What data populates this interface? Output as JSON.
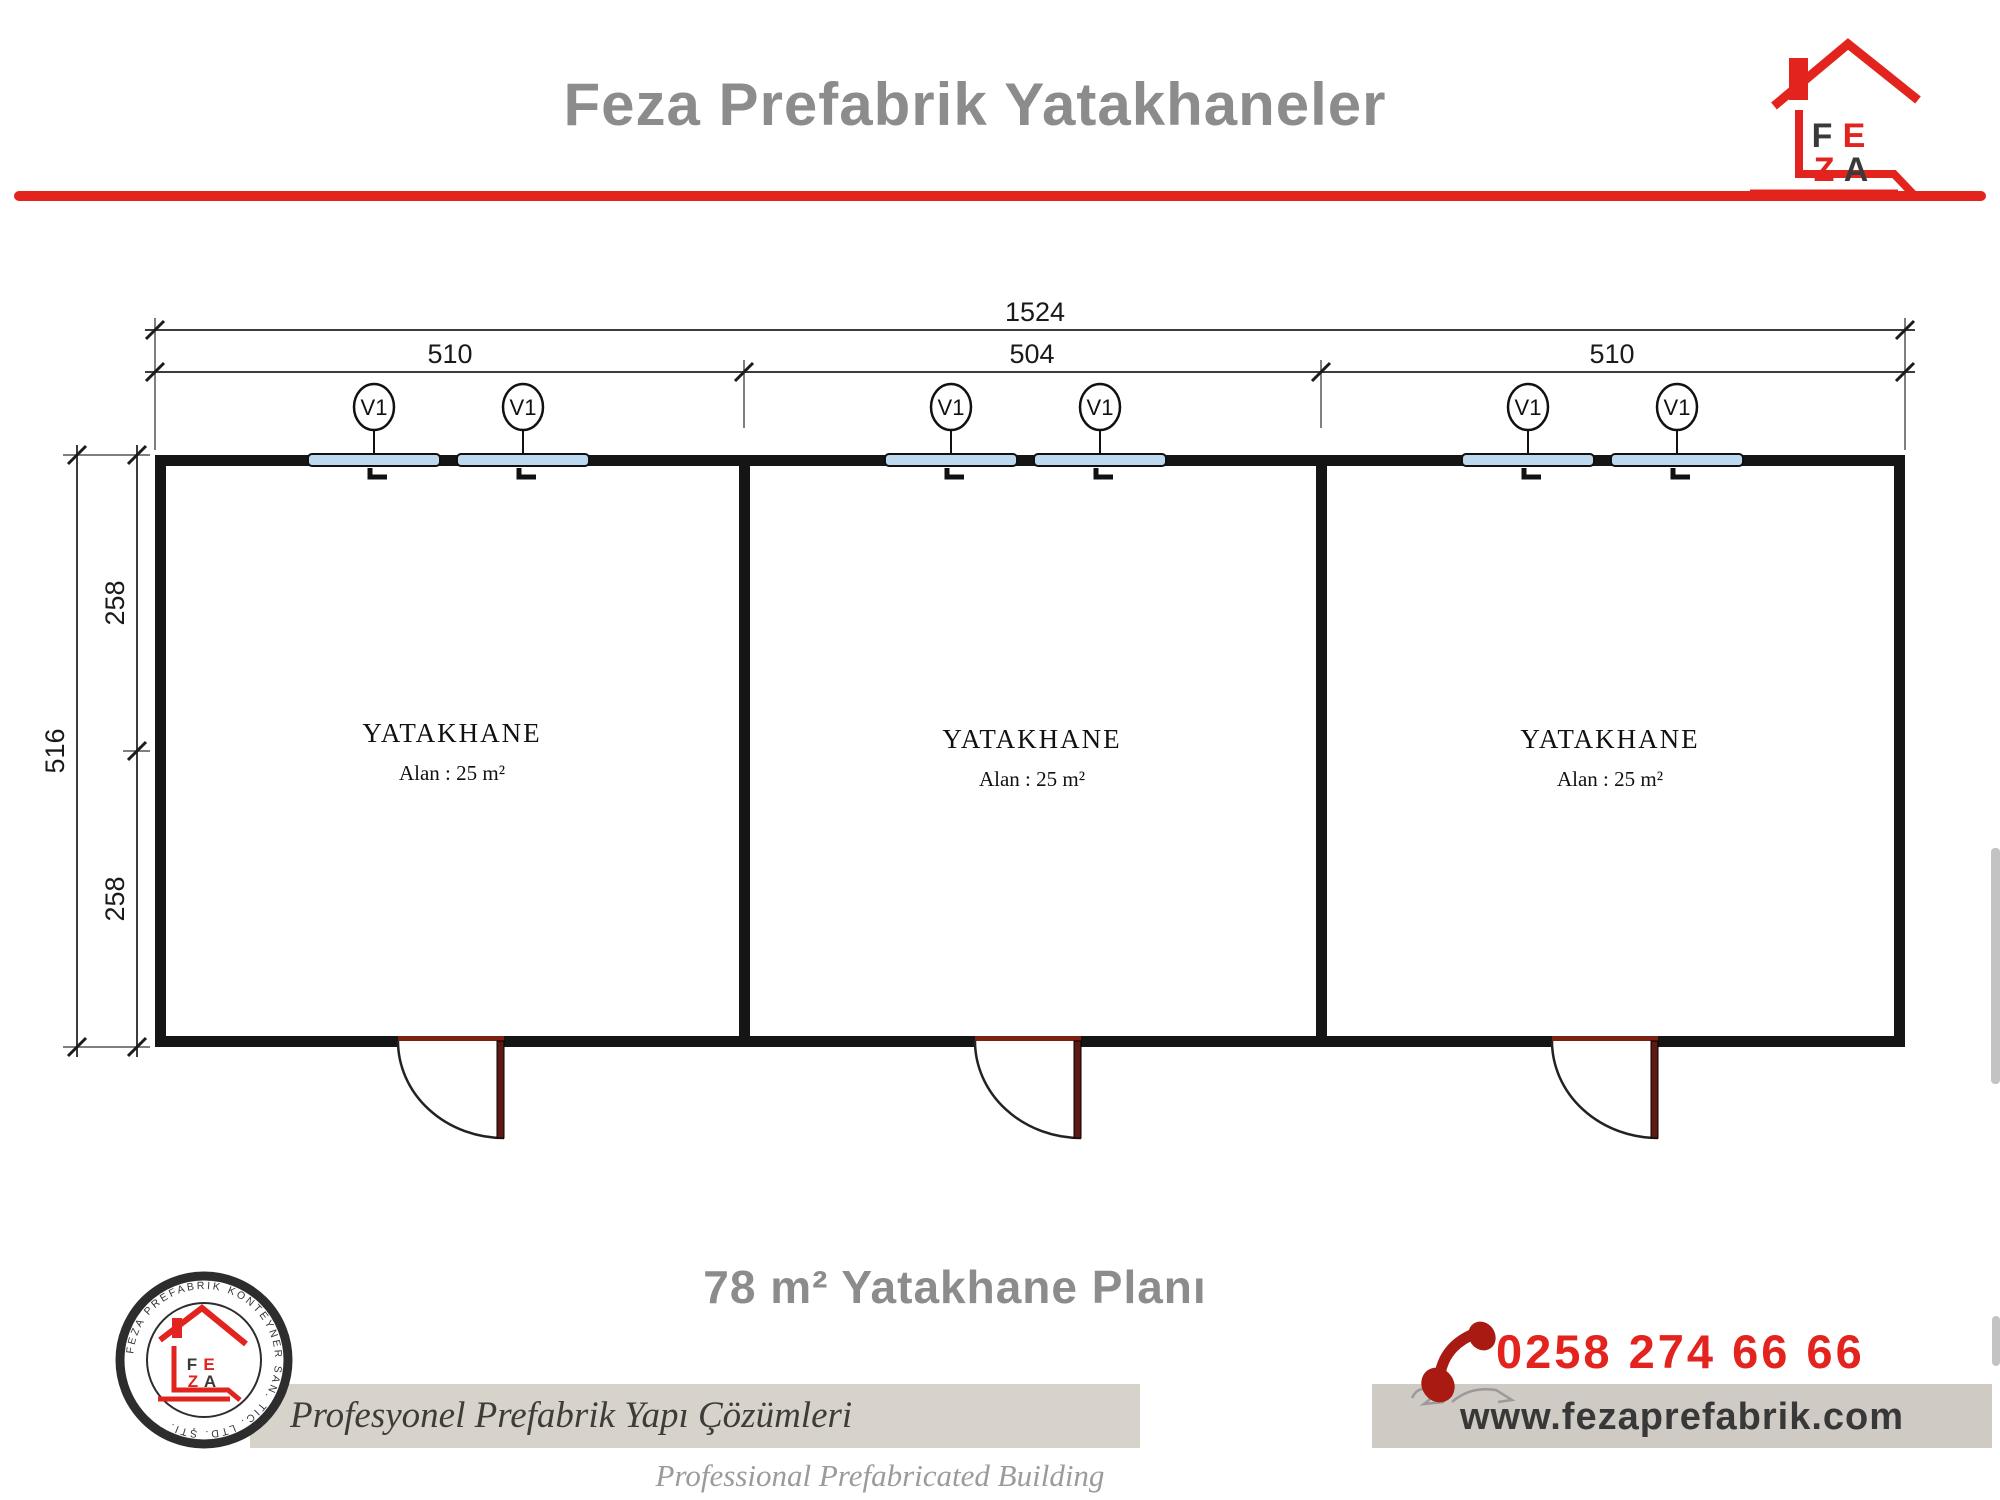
{
  "header": {
    "title": "Feza Prefabrik Yatakhaneler"
  },
  "brand": {
    "letter_f": "F",
    "letter_e": "E",
    "letter_z": "Z",
    "letter_a": "A"
  },
  "plan": {
    "dims": {
      "total_width": "1524",
      "width_segments": [
        "510",
        "504",
        "510"
      ],
      "total_height": "516",
      "height_segments": [
        "258",
        "258"
      ]
    },
    "rooms": [
      {
        "name": "YATAKHANE",
        "area": "Alan : 25 m²",
        "windows": [
          "V1",
          "V1"
        ]
      },
      {
        "name": "YATAKHANE",
        "area": "Alan : 25 m²",
        "windows": [
          "V1",
          "V1"
        ]
      },
      {
        "name": "YATAKHANE",
        "area": "Alan : 25 m²",
        "windows": [
          "V1",
          "V1"
        ]
      }
    ]
  },
  "footer": {
    "plan_title": "78 m² Yatakhane Planı",
    "tagline_tr": "Profesyonel Prefabrik Yapı Çözümleri",
    "tagline_en": "Professional Prefabricated Building Solutions",
    "phone": "0258 274 66 66",
    "website": "www.fezaprefabrik.com",
    "seal_text": "FEZA PREFABRİK KONTEYNER SAN. TİC. LTD. ŞTİ."
  },
  "colors": {
    "accent_red": "#e3231d",
    "title_gray": "#8c8c8c",
    "wall_black": "#151515",
    "window_blue": "#bcd9ef",
    "door_maroon": "#7c2012",
    "band_beige": "#d7d2ca",
    "band_gray": "#cfcac3",
    "website_text": "#383838"
  }
}
